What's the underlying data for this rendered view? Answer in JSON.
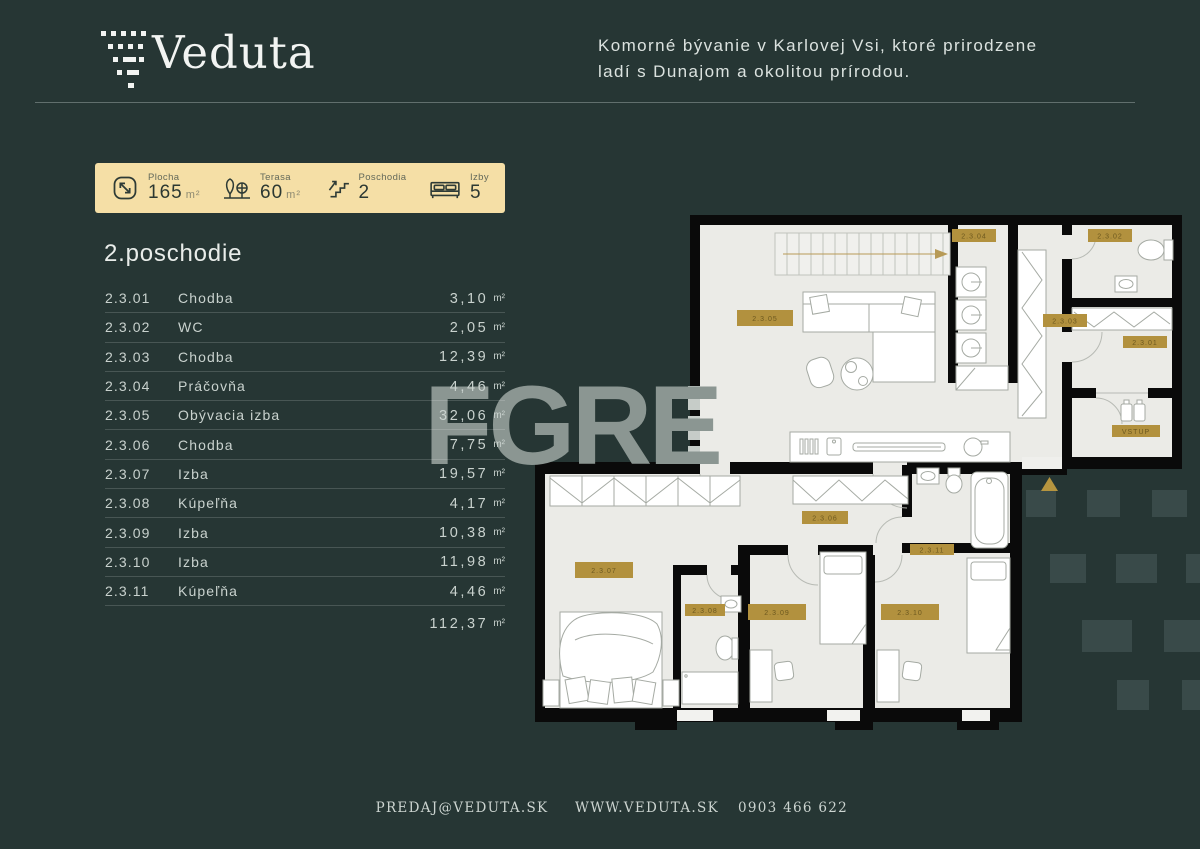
{
  "header": {
    "brand": "Veduta",
    "tagline_line1": "Komorné bývanie v Karlovej Vsi, ktoré prirodzene",
    "tagline_line2": "ladí s Dunajom a okolitou prírodou."
  },
  "stats": {
    "items": [
      {
        "icon": "area-icon",
        "label": "Plocha",
        "value": "165",
        "unit": "m²"
      },
      {
        "icon": "trees-icon",
        "label": "Terasa",
        "value": "60",
        "unit": "m²"
      },
      {
        "icon": "stairs-icon",
        "label": "Poschodia",
        "value": "2",
        "unit": ""
      },
      {
        "icon": "bed-icon",
        "label": "Izby",
        "value": "5",
        "unit": ""
      }
    ]
  },
  "floor": {
    "title": "2.poschodie",
    "unit": "m²",
    "rooms": [
      {
        "id": "2.3.01",
        "name": "Chodba",
        "area": "3,10"
      },
      {
        "id": "2.3.02",
        "name": "WC",
        "area": "2,05"
      },
      {
        "id": "2.3.03",
        "name": "Chodba",
        "area": "12,39"
      },
      {
        "id": "2.3.04",
        "name": "Práčovňa",
        "area": "4,46"
      },
      {
        "id": "2.3.05",
        "name": "Obývacia izba",
        "area": "32,06"
      },
      {
        "id": "2.3.06",
        "name": "Chodba",
        "area": "7,75"
      },
      {
        "id": "2.3.07",
        "name": "Izba",
        "area": "19,57"
      },
      {
        "id": "2.3.08",
        "name": "Kúpeľňa",
        "area": "4,17"
      },
      {
        "id": "2.3.09",
        "name": "Izba",
        "area": "10,38"
      },
      {
        "id": "2.3.10",
        "name": "Izba",
        "area": "11,98"
      },
      {
        "id": "2.3.11",
        "name": "Kúpeľňa",
        "area": "4,46"
      }
    ],
    "total_area": "112,37"
  },
  "plan": {
    "labels": {
      "l01": "2.3.01",
      "l02": "2.3.02",
      "l03": "2.3.03",
      "l04": "2.3.04",
      "l05": "2.3.05",
      "l06": "2.3.06",
      "l07": "2.3.07",
      "l08": "2.3.08",
      "l09": "2.3.09",
      "l10": "2.3.10",
      "l11": "2.3.11",
      "entrance": "VSTUP"
    }
  },
  "watermark": "FGRE",
  "footer": {
    "email": "PREDAJ@VEDUTA.SK",
    "web": "WWW.VEDUTA.SK",
    "phone": "0903 466 622"
  },
  "colors": {
    "background": "#263634",
    "card": "#f5dfa6",
    "gold": "#b2913e",
    "floor": "#ebebe7",
    "wall": "#0a0a0a",
    "text_light": "#c9d2ce",
    "watermark": "#8b9692"
  }
}
